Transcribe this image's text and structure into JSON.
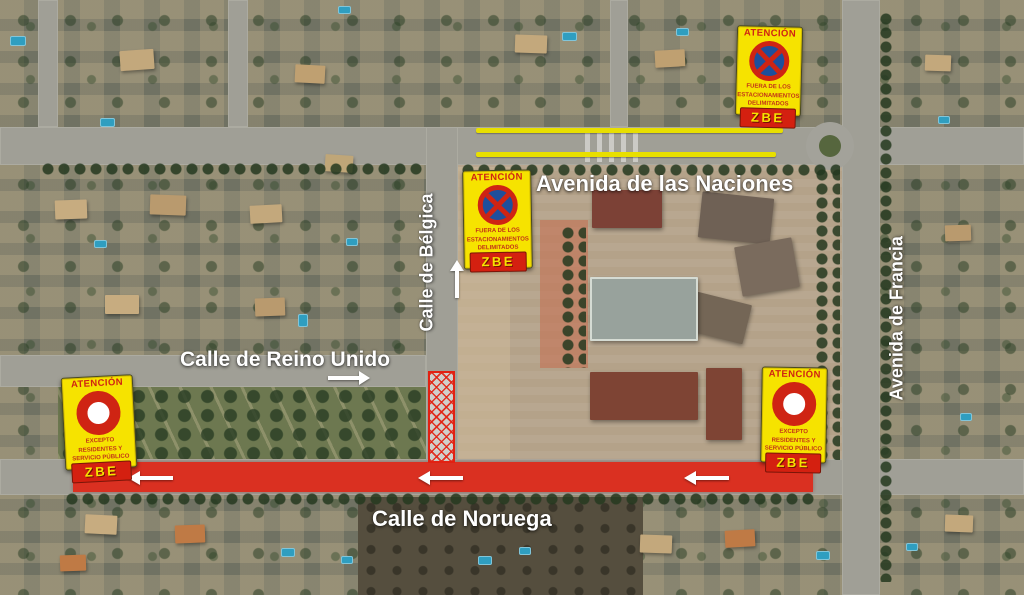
{
  "street_labels": {
    "naciones": "Avenida de las Naciones",
    "belgica": "Calle de Bélgica",
    "reino_unido": "Calle de Reino Unido",
    "noruega": "Calle de Noruega",
    "francia": "Avenida de Francia"
  },
  "signs": {
    "no_parking": {
      "header": "ATENCIÓN",
      "lines": [
        "FUERA DE LOS",
        "ESTACIONAMIENTOS",
        "DELIMITADOS"
      ],
      "zbe": "ZBE"
    },
    "no_entry": {
      "header": "ATENCIÓN",
      "lines": [
        "EXCEPTO",
        "RESIDENTES Y",
        "SERVICIO PÚBLICO"
      ],
      "zbe": "ZBE"
    }
  },
  "colors": {
    "no_parking_line": "#e8df00",
    "restricted_zone": "#e22112",
    "sign_yellow": "#f6e300",
    "sign_red": "#cf2413",
    "zbe_band": "#d42010",
    "arrow_white": "#ffffff"
  }
}
